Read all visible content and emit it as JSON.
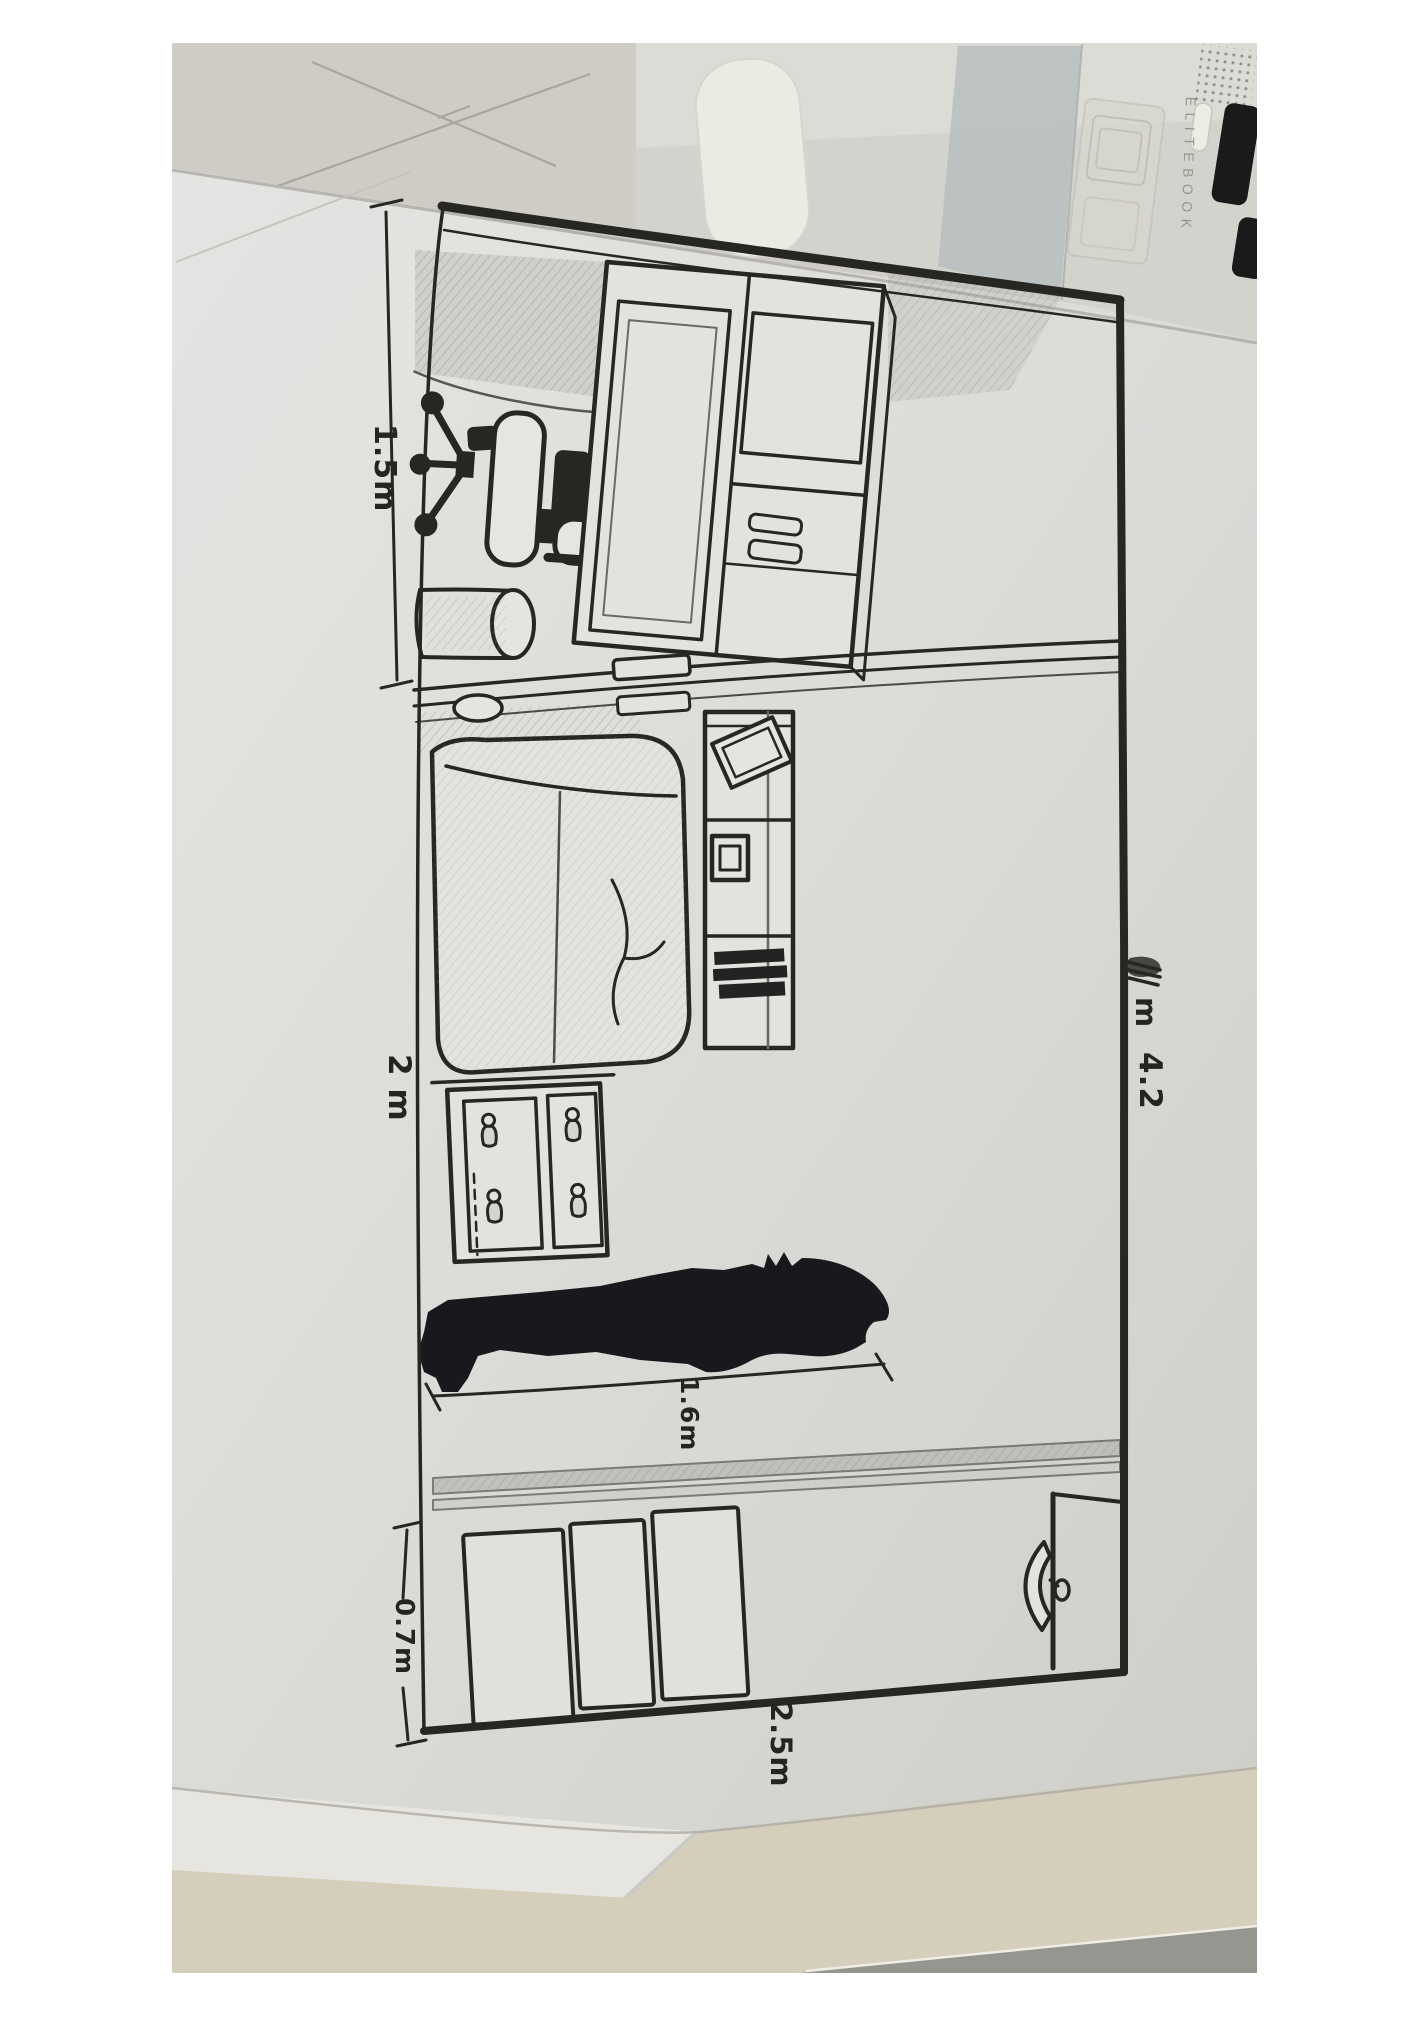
{
  "scene": {
    "description": "Photograph of a hand-drawn room floor plan sketched in marker and pencil on a sheet of paper, lying on a desk beside an HP EliteBook laptop"
  },
  "laptop": {
    "brand": "ELITEBOOK"
  },
  "drawing": {
    "dimension_labels": {
      "office_width": "1.5m",
      "living_width": "2 m",
      "room_length": "4.2",
      "room_length_unit": "m",
      "person_height": "1.6m",
      "closet_depth": "0.7m",
      "entry_wall": "2.5m"
    },
    "figures": [
      "room-outline",
      "office-chair",
      "desk",
      "bowl",
      "wardrobe",
      "waste-bin",
      "sofa",
      "shelf-unit",
      "picture-frame",
      "tv",
      "book-stack",
      "dresser",
      "person-silhouette",
      "closet-rail",
      "closet-panels",
      "door",
      "door-handle"
    ]
  },
  "colors": {
    "ink": "#23221f",
    "pencil": "#6b6863",
    "paper": "#e2e1de",
    "background_sheet": "#d2cfc7",
    "laptop_body": "#d7d6d0",
    "table": "#d8d1bd",
    "floor_dark": "#96968f"
  }
}
